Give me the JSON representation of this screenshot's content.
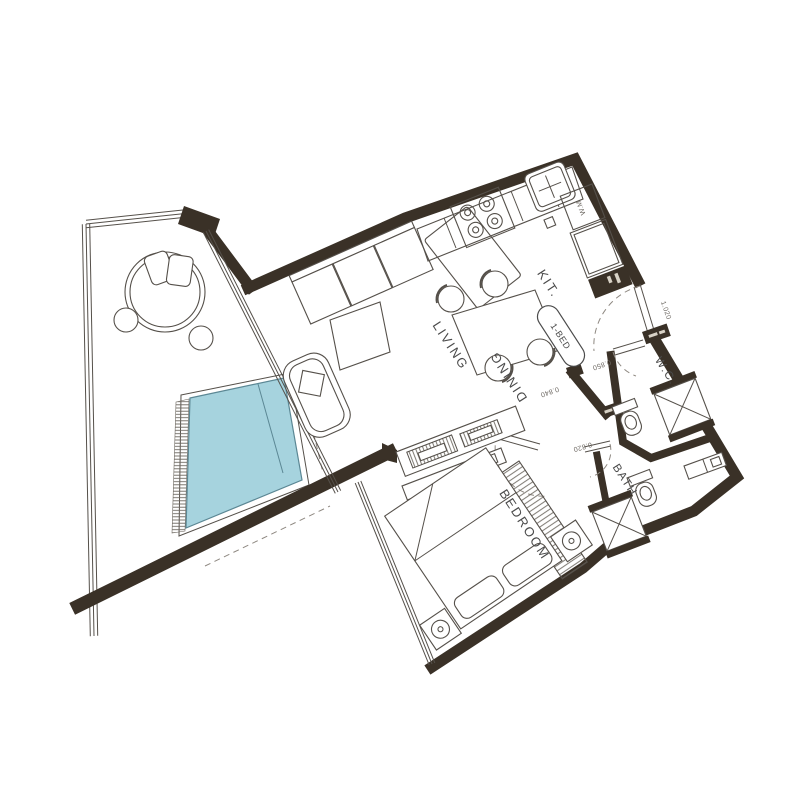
{
  "colors": {
    "wall": "#3a3127",
    "pool_fill": "#a6d3de",
    "pool_edge": "#5b8794",
    "line": "#55504a",
    "label": "#4b4b4b",
    "dim": "#6f6a64",
    "dash": "#8e8881",
    "cap_mark": "#d8d2c6"
  },
  "rooms": {
    "kitchen": "KIT.",
    "living": "LIVING",
    "dining": "DINING",
    "wc": "W.C.",
    "bath": "BATH",
    "bedroom": "BEDROOM"
  },
  "unit": {
    "type_badge": "1-BED"
  },
  "appliances": {
    "washing_machine": "W.M"
  },
  "door_dimensions": {
    "entry": "1.020",
    "wc": "0.850",
    "hall": "0.840",
    "bedroom": "0.820"
  }
}
